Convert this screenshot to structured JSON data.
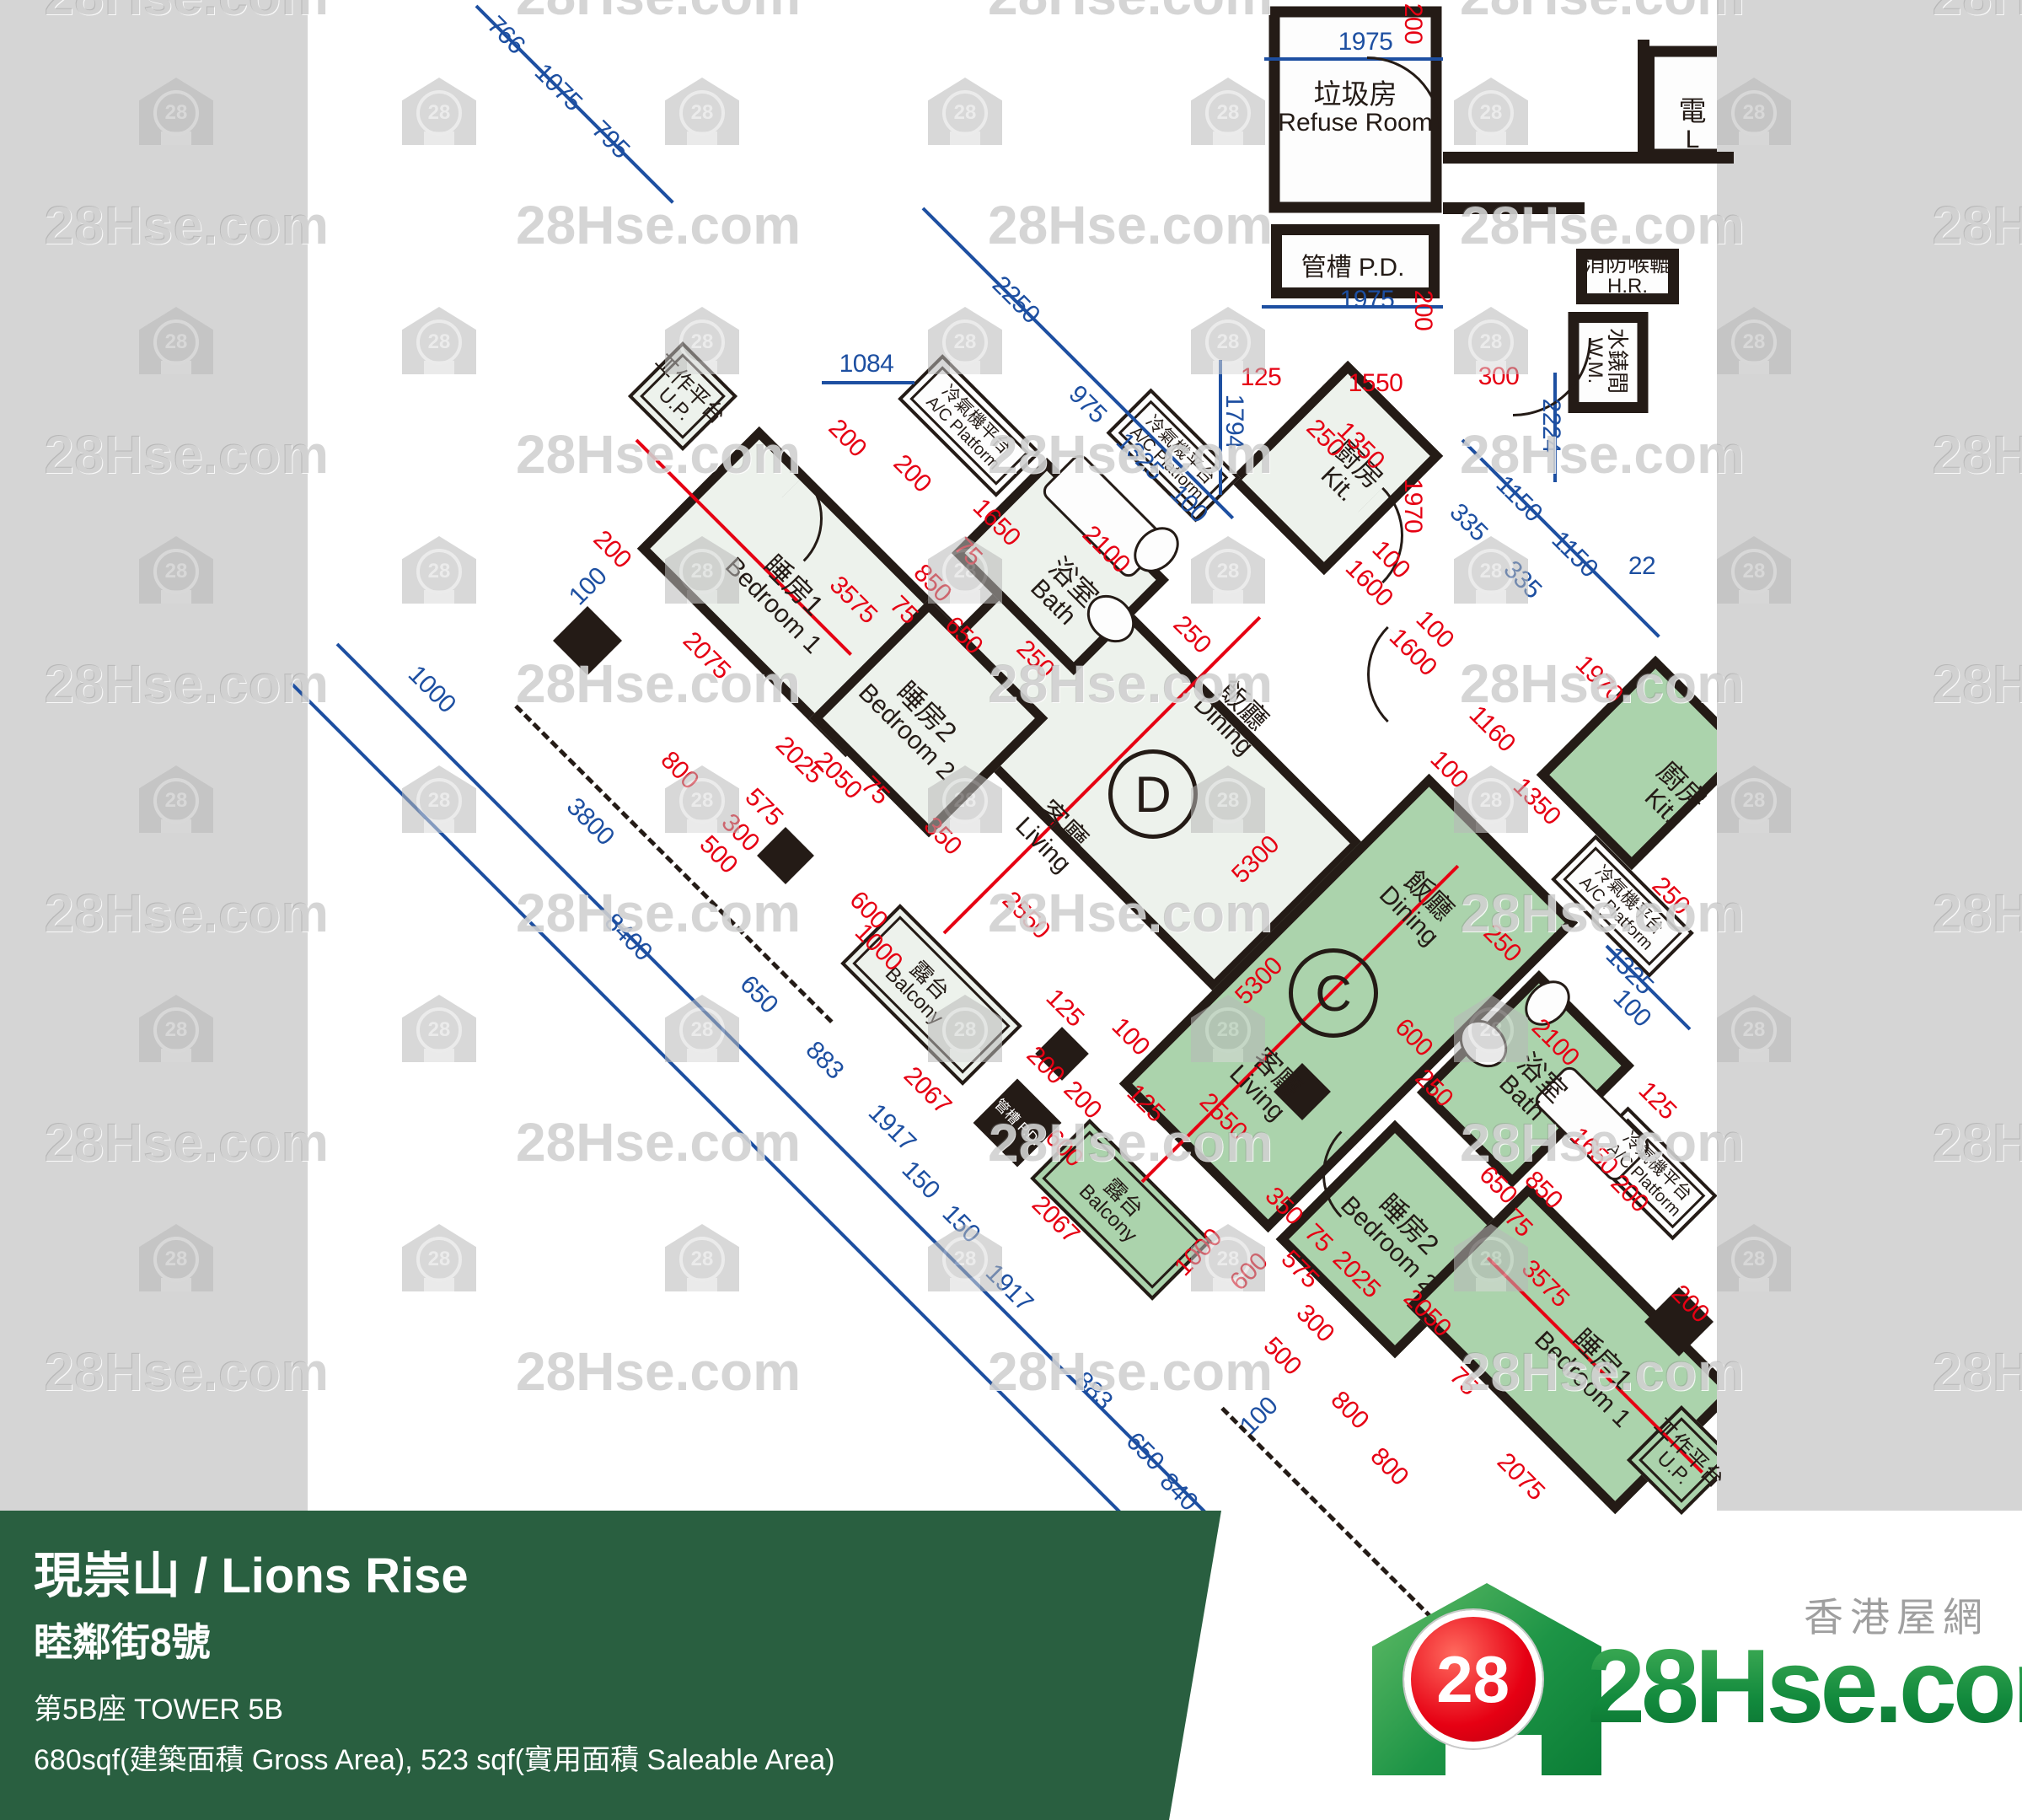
{
  "watermark": {
    "text": "28Hse.com",
    "badge": "28",
    "text_xs": [
      52,
      612,
      1172,
      1732,
      2292
    ],
    "text_ys": [
      -42,
      230,
      502,
      774,
      1046,
      1318,
      1590
    ],
    "icon_xs": [
      165,
      477,
      789,
      1101,
      1413,
      1725,
      2037
    ],
    "icon_ys": [
      92,
      364,
      636,
      908,
      1180,
      1452
    ]
  },
  "banner": {
    "title": "現崇山 / Lions Rise",
    "address": "睦鄰街8號",
    "tower": "第5B座   TOWER 5B",
    "area": "680sqf(建築面積 Gross Area), 523 sqf(實用面積 Saleable Area)"
  },
  "logo": {
    "brand": "28Hse.com",
    "site_zh": "香港屋網",
    "badge": "28"
  },
  "plan": {
    "unit_badges": [
      [
        "D",
        1368,
        942
      ],
      [
        "C",
        1582,
        1178
      ]
    ],
    "rooms": [
      [
        "refuse",
        1608,
        130,
        205,
        245,
        0,
        "w",
        "p"
      ],
      [
        "pd-top",
        1608,
        310,
        200,
        88,
        0,
        "w",
        "p"
      ],
      [
        "lift",
        2005,
        122,
        110,
        135,
        0,
        "w",
        "p"
      ],
      [
        "hr",
        1931,
        328,
        122,
        66,
        0,
        "w",
        "p"
      ],
      [
        "wm",
        1908,
        430,
        95,
        120,
        0,
        "w",
        "p"
      ],
      [
        "livdin-d",
        1345,
        905,
        520,
        250,
        45,
        "d",
        "p"
      ],
      [
        "bed1-d",
        952,
        702,
        350,
        205,
        45,
        "d",
        "p"
      ],
      [
        "bed2-d",
        1102,
        852,
        200,
        200,
        45,
        "d",
        "p"
      ],
      [
        "bath-d",
        1258,
        672,
        205,
        160,
        45,
        "d",
        "p"
      ],
      [
        "kit-d",
        1585,
        555,
        160,
        200,
        45,
        "d",
        "p"
      ],
      [
        "balc-d",
        1105,
        1180,
        205,
        100,
        45,
        "d",
        "dbl"
      ],
      [
        "up-d",
        810,
        470,
        92,
        92,
        45,
        "d",
        "dbl"
      ],
      [
        "ac1-d",
        1150,
        505,
        165,
        75,
        45,
        "w",
        "dbl"
      ],
      [
        "ac2-d",
        1392,
        540,
        150,
        75,
        45,
        "w",
        "dbl"
      ],
      [
        "livdin-c",
        1600,
        1190,
        250,
        520,
        45,
        "c",
        "p"
      ],
      [
        "kit-c",
        1950,
        905,
        160,
        200,
        45,
        "c",
        "p"
      ],
      [
        "bath-c",
        1810,
        1280,
        160,
        205,
        45,
        "c",
        "p"
      ],
      [
        "bed2-c",
        1655,
        1470,
        200,
        200,
        45,
        "c",
        "p"
      ],
      [
        "bed1-c",
        1865,
        1600,
        350,
        205,
        45,
        "c",
        "p"
      ],
      [
        "balc-c",
        1330,
        1435,
        205,
        100,
        45,
        "c",
        "dbl"
      ],
      [
        "up-c",
        1995,
        1732,
        92,
        92,
        45,
        "c",
        "dbl"
      ],
      [
        "ac1-c",
        1925,
        1075,
        165,
        75,
        45,
        "w",
        "dbl"
      ],
      [
        "ac2-c",
        1958,
        1392,
        150,
        75,
        45,
        "w",
        "dbl"
      ],
      [
        "pd-mid",
        1207,
        1332,
        74,
        74,
        45,
        "k",
        "p"
      ]
    ],
    "room_labels": [
      [
        "垃圾房",
        "Refuse Room",
        1608,
        128,
        0,
        "md"
      ],
      [
        "管槽 P.D.",
        "",
        1605,
        318,
        0,
        "one"
      ],
      [
        "電",
        "L",
        2008,
        148,
        0,
        "md"
      ],
      [
        "消防喉轆",
        "H.R.",
        1931,
        326,
        0,
        "sm"
      ],
      [
        "水錶間",
        "W.M.",
        1906,
        428,
        90,
        "sm"
      ],
      [
        "工作平台",
        "U.P.",
        810,
        470,
        45,
        "sm"
      ],
      [
        "睡房1",
        "Bedroom 1",
        930,
        706,
        45,
        "md"
      ],
      [
        "睡房2",
        "Bedroom 2",
        1088,
        856,
        45,
        "md"
      ],
      [
        "浴室",
        "Bath",
        1262,
        702,
        45,
        "md"
      ],
      [
        "廚房",
        "Kit.",
        1600,
        562,
        45,
        "md"
      ],
      [
        "飯廳",
        "Dining",
        1464,
        848,
        45,
        "md"
      ],
      [
        "客廳",
        "Living",
        1250,
        990,
        45,
        "md"
      ],
      [
        "露台",
        "Balcony",
        1094,
        1172,
        45,
        "sm"
      ],
      [
        "管槽 P.D.",
        "",
        1207,
        1332,
        45,
        "xsw"
      ],
      [
        "冷氣機平台",
        "A/C Platform",
        1150,
        506,
        45,
        "xs"
      ],
      [
        "冷氣機平台",
        "A/C Platform",
        1392,
        542,
        45,
        "xs"
      ],
      [
        "飯廳",
        "Dining",
        1684,
        1074,
        45,
        "md"
      ],
      [
        "客廳",
        "Living",
        1504,
        1284,
        45,
        "md"
      ],
      [
        "浴室",
        "Bath",
        1818,
        1290,
        45,
        "md"
      ],
      [
        "廚房",
        "Kit.",
        1984,
        944,
        45,
        "md"
      ],
      [
        "睡房2",
        "Bedroom 2",
        1660,
        1464,
        45,
        "md"
      ],
      [
        "睡房1",
        "Bedroom 1",
        1890,
        1624,
        45,
        "md"
      ],
      [
        "露台",
        "Balcony",
        1324,
        1430,
        45,
        "sm"
      ],
      [
        "工作平台",
        "U.P.",
        1995,
        1732,
        45,
        "sm"
      ],
      [
        "冷氣機平台",
        "A/C Platform",
        1925,
        1076,
        45,
        "xs"
      ],
      [
        "冷氣機平台",
        "A/C Platform",
        1958,
        1392,
        45,
        "xs"
      ]
    ],
    "dims": [
      [
        "766",
        600,
        42,
        45,
        "b"
      ],
      [
        "1075",
        662,
        104,
        45,
        "b"
      ],
      [
        "795",
        724,
        166,
        45,
        "b"
      ],
      [
        "2250",
        1205,
        356,
        45,
        "b"
      ],
      [
        "975",
        1290,
        480,
        45,
        "b"
      ],
      [
        "1325",
        1352,
        542,
        45,
        "b"
      ],
      [
        "100",
        1410,
        598,
        45,
        "b"
      ],
      [
        "1084",
        1028,
        432,
        0,
        "b"
      ],
      [
        "1975",
        1620,
        50,
        0,
        "b"
      ],
      [
        "1975",
        1622,
        356,
        0,
        "b"
      ],
      [
        "1794",
        1464,
        500,
        90,
        "b"
      ],
      [
        "2224",
        1840,
        505,
        90,
        "b"
      ],
      [
        "1150",
        1802,
        592,
        45,
        "b"
      ],
      [
        "1150",
        1868,
        658,
        45,
        "b"
      ],
      [
        "335",
        1742,
        620,
        45,
        "b"
      ],
      [
        "335",
        1806,
        688,
        45,
        "b"
      ],
      [
        "22",
        1948,
        672,
        0,
        "b"
      ],
      [
        "1000",
        512,
        818,
        45,
        "b"
      ],
      [
        "3800",
        700,
        975,
        45,
        "b"
      ],
      [
        "8400",
        745,
        1112,
        45,
        "b"
      ],
      [
        "650",
        900,
        1180,
        45,
        "b"
      ],
      [
        "883",
        978,
        1258,
        45,
        "b"
      ],
      [
        "1917",
        1058,
        1338,
        45,
        "b"
      ],
      [
        "150",
        1092,
        1400,
        45,
        "b"
      ],
      [
        "150",
        1140,
        1452,
        45,
        "b"
      ],
      [
        "1917",
        1197,
        1528,
        45,
        "b"
      ],
      [
        "883",
        1297,
        1650,
        45,
        "b"
      ],
      [
        "650",
        1358,
        1722,
        45,
        "b"
      ],
      [
        "840",
        1398,
        1770,
        45,
        "b"
      ],
      [
        "100",
        698,
        696,
        -45,
        "b"
      ],
      [
        "100",
        1494,
        1680,
        -45,
        "b"
      ],
      [
        "1325",
        1933,
        1152,
        45,
        "b"
      ],
      [
        "100",
        1936,
        1196,
        45,
        "b"
      ],
      [
        "200",
        1005,
        520,
        45,
        "r"
      ],
      [
        "200",
        1082,
        562,
        45,
        "r"
      ],
      [
        "200",
        726,
        652,
        45,
        "r"
      ],
      [
        "3575",
        1012,
        712,
        45,
        "r"
      ],
      [
        "2075",
        838,
        778,
        45,
        "r"
      ],
      [
        "800",
        806,
        914,
        45,
        "r"
      ],
      [
        "2025",
        948,
        902,
        45,
        "r"
      ],
      [
        "2050",
        994,
        920,
        45,
        "r"
      ],
      [
        "575",
        906,
        958,
        45,
        "r"
      ],
      [
        "300",
        878,
        988,
        45,
        "r"
      ],
      [
        "500",
        852,
        1014,
        45,
        "r"
      ],
      [
        "75",
        1038,
        938,
        45,
        "r"
      ],
      [
        "350",
        1118,
        992,
        45,
        "r"
      ],
      [
        "850",
        1106,
        692,
        45,
        "r"
      ],
      [
        "650",
        1143,
        754,
        45,
        "r"
      ],
      [
        "75",
        1072,
        724,
        45,
        "r"
      ],
      [
        "1650",
        1182,
        620,
        45,
        "r"
      ],
      [
        "75",
        1148,
        655,
        45,
        "r"
      ],
      [
        "2100",
        1312,
        652,
        45,
        "r"
      ],
      [
        "250",
        1228,
        782,
        45,
        "r"
      ],
      [
        "250",
        1414,
        753,
        45,
        "r"
      ],
      [
        "1550",
        1632,
        455,
        0,
        "r"
      ],
      [
        "300",
        1778,
        447,
        0,
        "r"
      ],
      [
        "125",
        1496,
        448,
        0,
        "r"
      ],
      [
        "1970",
        1676,
        600,
        90,
        "r"
      ],
      [
        "200",
        1676,
        28,
        90,
        "r"
      ],
      [
        "200",
        1688,
        368,
        90,
        "r"
      ],
      [
        "250",
        1572,
        520,
        45,
        "r"
      ],
      [
        "1350",
        1614,
        529,
        45,
        "r"
      ],
      [
        "100",
        1650,
        664,
        45,
        "r"
      ],
      [
        "1600",
        1624,
        692,
        45,
        "r"
      ],
      [
        "100",
        1702,
        747,
        45,
        "r"
      ],
      [
        "1600",
        1676,
        774,
        45,
        "r"
      ],
      [
        "2550",
        1217,
        1086,
        45,
        "r"
      ],
      [
        "125",
        1263,
        1196,
        45,
        "r"
      ],
      [
        "100",
        1341,
        1230,
        45,
        "r"
      ],
      [
        "200",
        1240,
        1264,
        45,
        "r"
      ],
      [
        "200",
        1284,
        1305,
        45,
        "r"
      ],
      [
        "125",
        1359,
        1309,
        45,
        "r"
      ],
      [
        "600",
        1262,
        1362,
        45,
        "r"
      ],
      [
        "5300",
        1490,
        1020,
        -45,
        "r"
      ],
      [
        "5300",
        1494,
        1164,
        -45,
        "r"
      ],
      [
        "600",
        1030,
        1080,
        45,
        "r"
      ],
      [
        "1000",
        1042,
        1124,
        45,
        "r"
      ],
      [
        "2067",
        1100,
        1294,
        45,
        "r"
      ],
      [
        "2067",
        1252,
        1447,
        45,
        "r"
      ],
      [
        "1000",
        1422,
        1486,
        -45,
        "r"
      ],
      [
        "600",
        1482,
        1509,
        -45,
        "r"
      ],
      [
        "250",
        1782,
        1119,
        45,
        "r"
      ],
      [
        "250",
        1701,
        1291,
        45,
        "r"
      ],
      [
        "1350",
        1823,
        951,
        45,
        "r"
      ],
      [
        "1160",
        1770,
        865,
        45,
        "r"
      ],
      [
        "100",
        1719,
        913,
        45,
        "r"
      ],
      [
        "2100",
        1845,
        1237,
        45,
        "r"
      ],
      [
        "1650",
        1891,
        1366,
        45,
        "r"
      ],
      [
        "125",
        1966,
        1306,
        45,
        "r"
      ],
      [
        "1970",
        1897,
        806,
        45,
        "r"
      ],
      [
        "250",
        1982,
        1063,
        45,
        "r"
      ],
      [
        "600",
        1677,
        1231,
        45,
        "r"
      ],
      [
        "2550",
        1451,
        1325,
        45,
        "r"
      ],
      [
        "350",
        1523,
        1431,
        45,
        "r"
      ],
      [
        "75",
        1564,
        1469,
        45,
        "r"
      ],
      [
        "2025",
        1609,
        1512,
        45,
        "r"
      ],
      [
        "575",
        1542,
        1506,
        45,
        "r"
      ],
      [
        "300",
        1560,
        1570,
        45,
        "r"
      ],
      [
        "500",
        1521,
        1609,
        45,
        "r"
      ],
      [
        "800",
        1601,
        1673,
        45,
        "r"
      ],
      [
        "800",
        1648,
        1740,
        45,
        "r"
      ],
      [
        "2050",
        1693,
        1558,
        45,
        "r"
      ],
      [
        "75",
        1736,
        1639,
        45,
        "r"
      ],
      [
        "2075",
        1804,
        1752,
        45,
        "r"
      ],
      [
        "3575",
        1833,
        1523,
        45,
        "r"
      ],
      [
        "650",
        1777,
        1406,
        45,
        "r"
      ],
      [
        "850",
        1831,
        1412,
        45,
        "r"
      ],
      [
        "75",
        1801,
        1451,
        45,
        "r"
      ],
      [
        "200",
        1933,
        1416,
        45,
        "r"
      ],
      [
        "200",
        2005,
        1547,
        45,
        "r"
      ]
    ],
    "lines": [
      [
        "b",
        565,
        5,
        330,
        45
      ],
      [
        "b",
        1500,
        68,
        212,
        0
      ],
      [
        "b",
        1497,
        362,
        215,
        0
      ],
      [
        "b",
        1095,
        245,
        520,
        45
      ],
      [
        "b",
        1448,
        425,
        160,
        90
      ],
      [
        "b",
        1845,
        440,
        130,
        90
      ],
      [
        "b",
        1735,
        520,
        330,
        45
      ],
      [
        "b",
        975,
        452,
        110,
        0
      ],
      [
        "b",
        400,
        762,
        1470,
        45
      ],
      [
        "b",
        345,
        808,
        1500,
        45
      ],
      [
        "b",
        1906,
        1120,
        140,
        45
      ],
      [
        "r",
        755,
        520,
        360,
        45
      ],
      [
        "r",
        1120,
        1105,
        530,
        -45
      ],
      [
        "r",
        1355,
        1400,
        530,
        -45
      ],
      [
        "r",
        1765,
        1490,
        360,
        45
      ],
      [
        "k",
        1712,
        180,
        345,
        0,
        14
      ],
      [
        "k",
        1712,
        240,
        168,
        0,
        14
      ],
      [
        "k",
        1950,
        40,
        145,
        90,
        14
      ],
      [
        "d",
        612,
        835,
        530,
        45
      ],
      [
        "d",
        1450,
        1668,
        560,
        45
      ]
    ],
    "columns": [
      [
        697,
        760,
        58
      ],
      [
        932,
        1015,
        48
      ],
      [
        1260,
        1250,
        45
      ],
      [
        1545,
        1295,
        48
      ],
      [
        1992,
        1568,
        58
      ]
    ],
    "fixtures": [
      [
        "tub",
        1310,
        612,
        150,
        68
      ],
      [
        "sink",
        1318,
        734,
        62,
        50
      ],
      [
        "toilet",
        1372,
        652,
        46,
        60
      ],
      [
        "tub",
        1889,
        1333,
        140,
        64
      ],
      [
        "sink",
        1760,
        1238,
        62,
        50
      ],
      [
        "toilet",
        1836,
        1190,
        46,
        60
      ]
    ],
    "arcs": [
      [
        1622,
        152,
        85,
        0
      ],
      [
        1795,
        398,
        90,
        90
      ],
      [
        1584,
        632,
        78,
        45
      ],
      [
        1703,
        797,
        78,
        225
      ],
      [
        903,
        612,
        70,
        45
      ],
      [
        1642,
        1390,
        70,
        225
      ]
    ]
  }
}
